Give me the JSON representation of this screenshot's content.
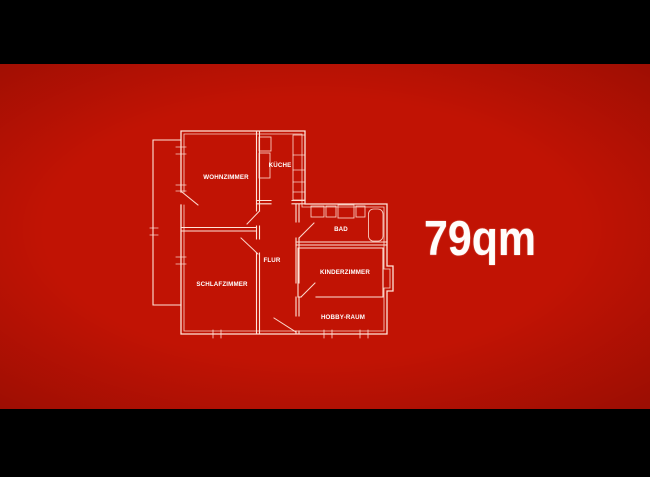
{
  "frame": {
    "area_text": "79qm"
  },
  "floor_plan": {
    "rooms": [
      {
        "id": "wohnzimmer",
        "label": "WOHNZIMMER"
      },
      {
        "id": "kueche",
        "label": "KÜCHE"
      },
      {
        "id": "bad",
        "label": "BAD"
      },
      {
        "id": "flur",
        "label": "FLUR"
      },
      {
        "id": "schlafzimmer",
        "label": "SCHLAFZIMMER"
      },
      {
        "id": "kinderzimmer",
        "label": "KINDERZIMMER"
      },
      {
        "id": "hobbyraum",
        "label": "HOBBY-RAUM"
      }
    ]
  },
  "colors": {
    "background_red": "#c11304",
    "letterbox_black": "#000000",
    "plan_line": "#ffe3d8",
    "label_text": "#ffffff"
  }
}
